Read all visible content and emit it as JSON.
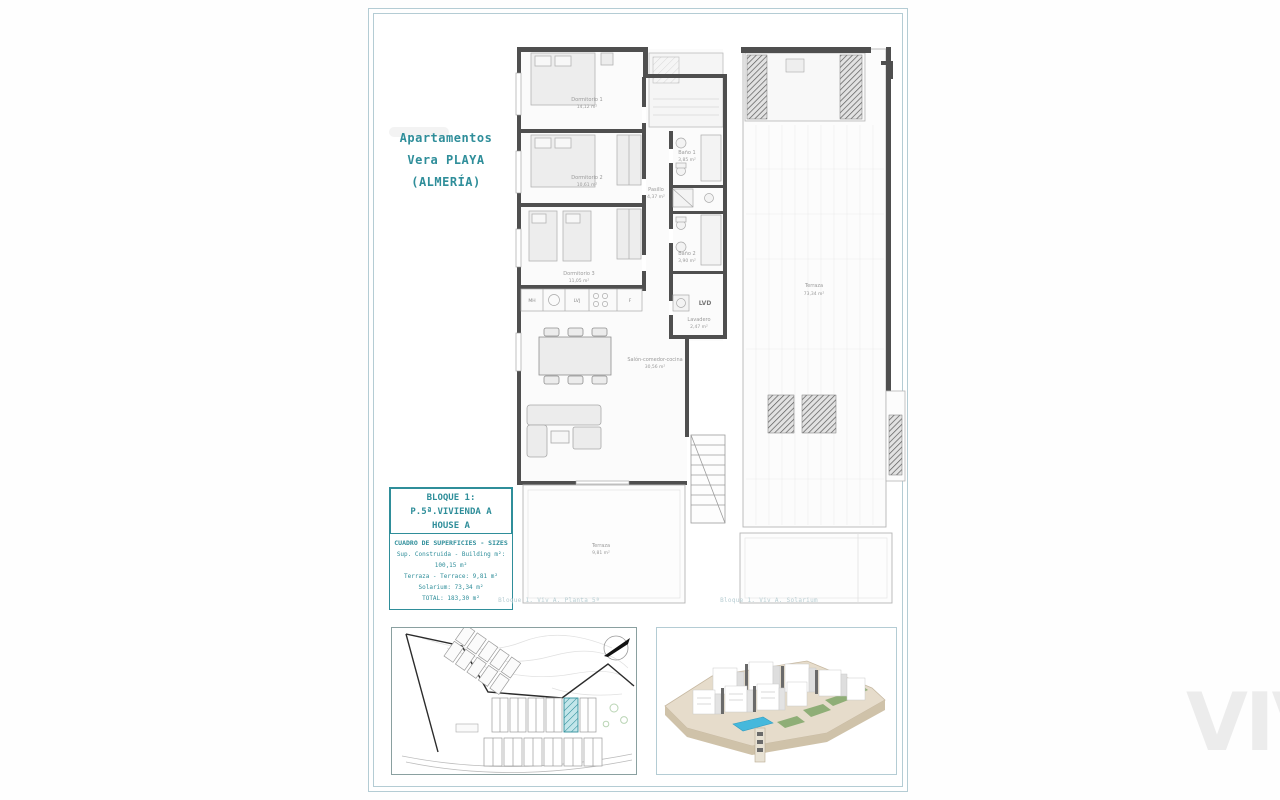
{
  "title": {
    "line1": "Apartamentos",
    "line2": "Vera PLAYA",
    "line3": "(ALMERÍA)"
  },
  "block_box": {
    "line1": "BLOQUE 1:",
    "line2": "P.5ª.VIVIENDA A",
    "line3": "HOUSE A"
  },
  "surface_box": {
    "title": "CUADRO DE SUPERFICIES - SIZES",
    "row1": "Sup. Construida - Building m²: 100,15 m²",
    "row2": "Terraza - Terrace: 9,81 m²",
    "row3": "Solarium: 73,34 m²",
    "row4": "TOTAL: 183,30 m²"
  },
  "captions": {
    "floor_plan": "Bloque 1. Viv A. Planta 5ª",
    "solarium": "Bloque 1. Viv A. Solarium"
  },
  "floor_plan": {
    "dorm1_name": "Dormitorio 1",
    "dorm1_area": "14,12 m²",
    "dorm2_name": "Dormitorio 2",
    "dorm2_area": "10,61 m²",
    "dorm3_name": "Dormitorio 3",
    "dorm3_area": "11,05 m²",
    "hall_name": "Pasillo",
    "hall_area": "4,37 m²",
    "bath1_name": "Baño 1",
    "bath1_area": "3,85 m²",
    "bath2_name": "Baño 2",
    "bath2_area": "3,90 m²",
    "laundry_name": "Lavadero",
    "laundry_area": "2,47 m²",
    "living_name": "Salón-comedor-cocina",
    "living_area": "30,56 m²",
    "terrace_name": "Terraza",
    "terrace_area": "9,81 m²",
    "appliances": {
      "mh": "MH",
      "lvj": "LVJ",
      "f": "F",
      "lvd": "LVD"
    }
  },
  "solarium_plan": {
    "terrace_name": "Terraza",
    "terrace_area": "73,34 m²"
  },
  "watermark": "VIVE",
  "colors": {
    "accent_teal": "#2f8e9a",
    "frame_blue": "#b4ccd4",
    "wall_gray": "#4f4f4f",
    "highlight_hatch": "#7fc6cf",
    "pool_blue": "#45b8dc"
  }
}
